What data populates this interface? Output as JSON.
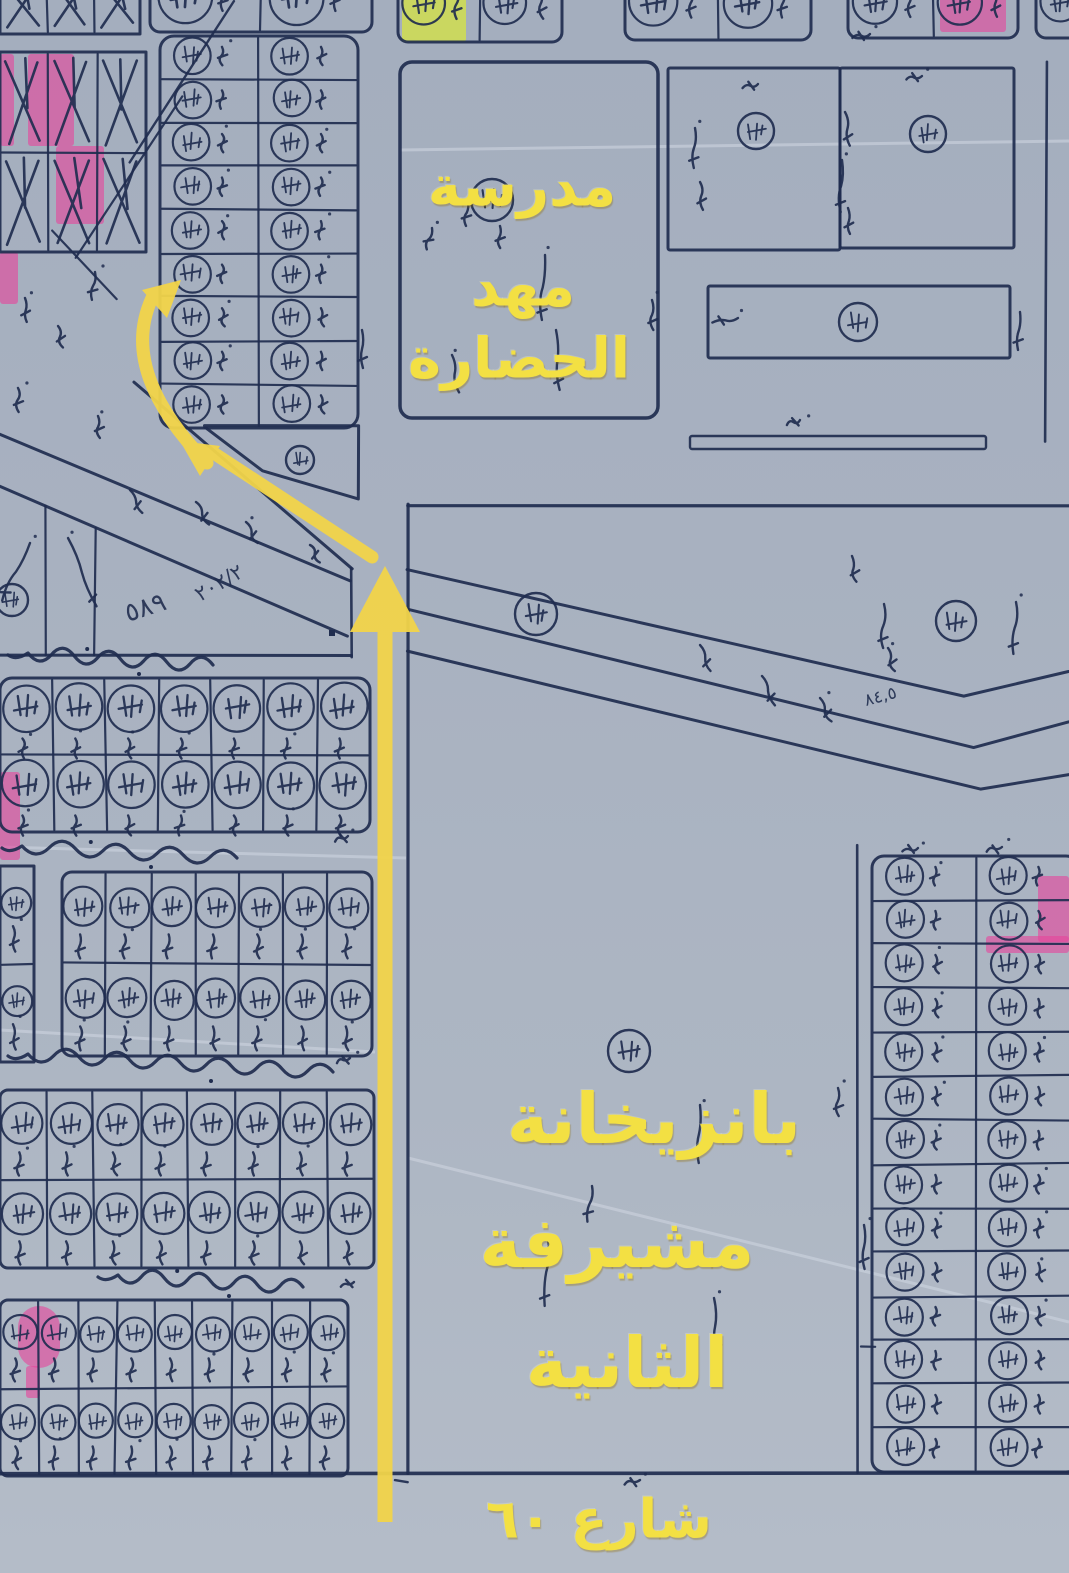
{
  "annotations": {
    "school_label": {
      "line1": "مدرسة",
      "line2": "مهد",
      "line3": "الحضارة"
    },
    "station_label": {
      "line1": "بانزيخانة",
      "line2": "مشيرفة",
      "line3": "الثانية"
    },
    "street_label": {
      "text": "شارع ٦٠"
    }
  },
  "colors": {
    "paper": "#a8b1c0",
    "ink": "#202d4f",
    "annotation_yellow": "#f3e043",
    "arrow_yellow": "#f2d44a",
    "highlight_pink": "#e8439b",
    "highlight_green": "#d8e83c",
    "crease": "#cdd4e0"
  },
  "route_arrows": {
    "vertical": {
      "x": 385,
      "y1": 1522,
      "y2": 625,
      "head": [
        [
          350,
          632
        ],
        [
          385,
          566
        ],
        [
          420,
          632
        ]
      ]
    },
    "diagonal": {
      "x1": 372,
      "y1": 557,
      "x2": 212,
      "y2": 452,
      "head": [
        [
          180,
          441
        ],
        [
          220,
          446
        ],
        [
          200,
          476
        ]
      ]
    },
    "curved": {
      "path": "M 207 463 Q 118 372 152 298",
      "head": [
        [
          181,
          280
        ],
        [
          167,
          318
        ],
        [
          142,
          290
        ]
      ]
    }
  },
  "map": {
    "creases": [
      [
        400,
        150,
        1069,
        141
      ],
      [
        0,
        847,
        406,
        858
      ],
      [
        408,
        1158,
        1069,
        1322
      ],
      [
        0,
        1030,
        375,
        1052
      ]
    ],
    "highlights": [
      {
        "x": 402,
        "y": -12,
        "w": 64,
        "h": 54,
        "c": "green"
      },
      {
        "x": 940,
        "y": -14,
        "w": 66,
        "h": 46,
        "c": "pink"
      },
      {
        "x": 28,
        "y": 54,
        "w": 46,
        "h": 92,
        "c": "pink"
      },
      {
        "x": 0,
        "y": 54,
        "w": 14,
        "h": 92,
        "c": "pink"
      },
      {
        "x": 56,
        "y": 146,
        "w": 48,
        "h": 78,
        "c": "pink"
      },
      {
        "x": 0,
        "y": 252,
        "w": 18,
        "h": 52,
        "c": "pink"
      },
      {
        "x": 0,
        "y": 772,
        "w": 20,
        "h": 88,
        "c": "pink"
      },
      {
        "x": 18,
        "y": 1306,
        "w": 42,
        "h": 62,
        "c": "pink",
        "round": true
      },
      {
        "x": 26,
        "y": 1366,
        "w": 14,
        "h": 32,
        "c": "pink"
      },
      {
        "x": 1038,
        "y": 876,
        "w": 31,
        "h": 66,
        "c": "pink"
      },
      {
        "x": 986,
        "y": 936,
        "w": 83,
        "h": 17,
        "c": "pink"
      }
    ],
    "grids": [
      {
        "x": 150,
        "y": -32,
        "w": 222,
        "h": 64,
        "cols": 2,
        "rows": 1,
        "cell": "circle",
        "r": 10
      },
      {
        "x": 398,
        "y": -28,
        "w": 164,
        "h": 70,
        "cols": 2,
        "rows": 1,
        "cell": "circle",
        "r": 10
      },
      {
        "x": 625,
        "y": -28,
        "w": 186,
        "h": 68,
        "cols": 2,
        "rows": 1,
        "cell": "circle",
        "r": 10
      },
      {
        "x": 848,
        "y": -26,
        "w": 170,
        "h": 64,
        "cols": 2,
        "rows": 1,
        "cell": "circle",
        "r": 10
      },
      {
        "x": 1036,
        "y": -26,
        "w": 76,
        "h": 64,
        "cols": 1,
        "rows": 1,
        "cell": "circle",
        "r": 10
      },
      {
        "x": 0,
        "y": -26,
        "w": 140,
        "h": 60,
        "cols": 3,
        "rows": 1,
        "cell": "hatch",
        "r": 0
      },
      {
        "x": 0,
        "y": 52,
        "w": 146,
        "h": 200,
        "cols": 3,
        "rows": 2,
        "cell": "hatch",
        "r": 0
      },
      {
        "x": 160,
        "y": 36,
        "w": 198,
        "h": 392,
        "cols": 2,
        "rows": 9,
        "cell": "circle",
        "r": 14
      },
      {
        "x": 0,
        "y": 678,
        "w": 370,
        "h": 154,
        "cols": 7,
        "rows": 2,
        "cell": "circle",
        "r": 12
      },
      {
        "x": 0,
        "y": 866,
        "w": 34,
        "h": 196,
        "cols": 1,
        "rows": 2,
        "cell": "circle",
        "r": 0
      },
      {
        "x": 62,
        "y": 872,
        "w": 310,
        "h": 184,
        "cols": 7,
        "rows": 2,
        "cell": "circle",
        "r": 10
      },
      {
        "x": 0,
        "y": 1090,
        "w": 374,
        "h": 178,
        "cols": 8,
        "rows": 2,
        "cell": "circle",
        "r": 8
      },
      {
        "x": 0,
        "y": 1300,
        "w": 348,
        "h": 176,
        "cols": 9,
        "rows": 2,
        "cell": "circle",
        "r": 8
      },
      {
        "x": 872,
        "y": 856,
        "w": 206,
        "h": 616,
        "cols": 2,
        "rows": 14,
        "cell": "circle",
        "r": 12
      }
    ],
    "rects": [
      {
        "x": 400,
        "y": 62,
        "w": 258,
        "h": 356,
        "r": 12,
        "sw": 3.5
      },
      {
        "x": 668,
        "y": 68,
        "w": 172,
        "h": 182,
        "r": 2,
        "sw": 3
      },
      {
        "x": 840,
        "y": 68,
        "w": 174,
        "h": 180,
        "r": 2,
        "sw": 3
      },
      {
        "x": 708,
        "y": 286,
        "w": 302,
        "h": 72,
        "r": 2,
        "sw": 3
      },
      {
        "x": 690,
        "y": 436,
        "w": 296,
        "h": 13,
        "r": 2,
        "sw": 2.4
      }
    ],
    "circles": [
      [
        492,
        200,
        21
      ],
      [
        756,
        131,
        18
      ],
      [
        928,
        134,
        18
      ],
      [
        858,
        322,
        19
      ],
      [
        536,
        614,
        21
      ],
      [
        956,
        621,
        20
      ],
      [
        629,
        1051,
        21
      ],
      [
        12,
        600,
        16
      ],
      [
        300,
        460,
        14
      ]
    ],
    "lines": [
      [
        233,
        2,
        130,
        163,
        2.4
      ],
      [
        182,
        97,
        75,
        257,
        2.2
      ],
      [
        53,
        230,
        117,
        300,
        2.2
      ],
      [
        133,
        383,
        352,
        568,
        3
      ],
      [
        0,
        434,
        350,
        581,
        3
      ],
      [
        0,
        487,
        347,
        637,
        3
      ],
      [
        0,
        656,
        352,
        656,
        3
      ],
      [
        352,
        568,
        352,
        658,
        2.6
      ],
      [
        45,
        506,
        45,
        655,
        2.2
      ],
      [
        95,
        528,
        95,
        655,
        2.2
      ],
      [
        408,
        505,
        408,
        1473,
        3.2
      ],
      [
        408,
        505,
        1069,
        505,
        3.2
      ],
      [
        0,
        1474,
        1069,
        1474,
        3.6
      ],
      [
        857,
        845,
        857,
        1472,
        2.6
      ],
      [
        1046,
        62,
        1046,
        442,
        2.6
      ],
      [
        860,
        1347,
        876,
        1347,
        2.2
      ],
      [
        394,
        1481,
        408,
        1483,
        2.4
      ]
    ],
    "polylines": [
      [
        [
          408,
          570
        ],
        [
          963,
          696
        ],
        [
          1069,
          672
        ]
      ],
      [
        [
          408,
          610
        ],
        [
          973,
          748
        ],
        [
          1069,
          722
        ]
      ],
      [
        [
          408,
          652
        ],
        [
          980,
          790
        ],
        [
          1069,
          775
        ]
      ],
      [
        [
          205,
          426
        ],
        [
          358,
          426
        ],
        [
          358,
          498
        ],
        [
          262,
          470
        ],
        [
          205,
          426
        ]
      ]
    ],
    "label_squiggles": [
      [
        28,
        665,
        185
      ],
      [
        22,
        858,
        215
      ],
      [
        28,
        1072,
        305
      ],
      [
        118,
        1287,
        185
      ]
    ],
    "vmarks": [
      [
        545,
        255,
        65,
        4
      ],
      [
        556,
        330,
        60,
        -3
      ],
      [
        452,
        355,
        38,
        -8
      ],
      [
        468,
        200,
        26,
        6
      ],
      [
        432,
        228,
        22,
        14
      ],
      [
        500,
        226,
        22,
        3
      ],
      [
        695,
        128,
        40,
        3
      ],
      [
        700,
        182,
        28,
        -5
      ],
      [
        845,
        112,
        34,
        -8
      ],
      [
        842,
        160,
        52,
        2
      ],
      [
        848,
        208,
        26,
        -4
      ],
      [
        758,
        84,
        16,
        78
      ],
      [
        922,
        76,
        16,
        78
      ],
      [
        870,
        34,
        18,
        80
      ],
      [
        652,
        300,
        30,
        0
      ],
      [
        738,
        318,
        26,
        80
      ],
      [
        1020,
        312,
        38,
        4
      ],
      [
        800,
        420,
        14,
        72
      ],
      [
        130,
        490,
        26,
        -28
      ],
      [
        196,
        502,
        26,
        -28
      ],
      [
        246,
        522,
        24,
        -28
      ],
      [
        310,
        545,
        20,
        -28
      ],
      [
        700,
        645,
        28,
        -22
      ],
      [
        762,
        676,
        32,
        -22
      ],
      [
        820,
        698,
        26,
        -22
      ],
      [
        852,
        556,
        26,
        -6
      ],
      [
        884,
        604,
        44,
        2
      ],
      [
        888,
        648,
        24,
        -12
      ],
      [
        1016,
        602,
        52,
        3
      ],
      [
        700,
        1105,
        58,
        2
      ],
      [
        548,
        1238,
        68,
        3
      ],
      [
        714,
        1298,
        58,
        -2
      ],
      [
        838,
        1088,
        28,
        2
      ],
      [
        592,
        1186,
        36,
        8
      ],
      [
        864,
        1225,
        44,
        0
      ],
      [
        918,
        848,
        16,
        78
      ],
      [
        1002,
        847,
        16,
        78
      ],
      [
        348,
        836,
        14,
        72
      ],
      [
        350,
        1058,
        14,
        72
      ],
      [
        354,
        1282,
        14,
        72
      ],
      [
        640,
        1480,
        16,
        78
      ],
      [
        95,
        272,
        28,
        8
      ],
      [
        25,
        298,
        24,
        -4
      ],
      [
        58,
        326,
        22,
        -10
      ],
      [
        18,
        388,
        24,
        2
      ],
      [
        98,
        416,
        22,
        0
      ],
      [
        362,
        330,
        38,
        0
      ],
      [
        30,
        543,
        64,
        26
      ],
      [
        68,
        538,
        74,
        -22
      ]
    ],
    "dots": [
      [
        332,
        633
      ]
    ],
    "texts": [
      {
        "t": "٥٨٩",
        "x": 128,
        "y": 622,
        "size": 26,
        "rot": -18
      },
      {
        "t": "٢٠٢/٢",
        "x": 200,
        "y": 602,
        "size": 21,
        "rot": -30
      },
      {
        "t": "٨٤,٥",
        "x": 866,
        "y": 706,
        "size": 17,
        "rot": -15
      }
    ]
  }
}
